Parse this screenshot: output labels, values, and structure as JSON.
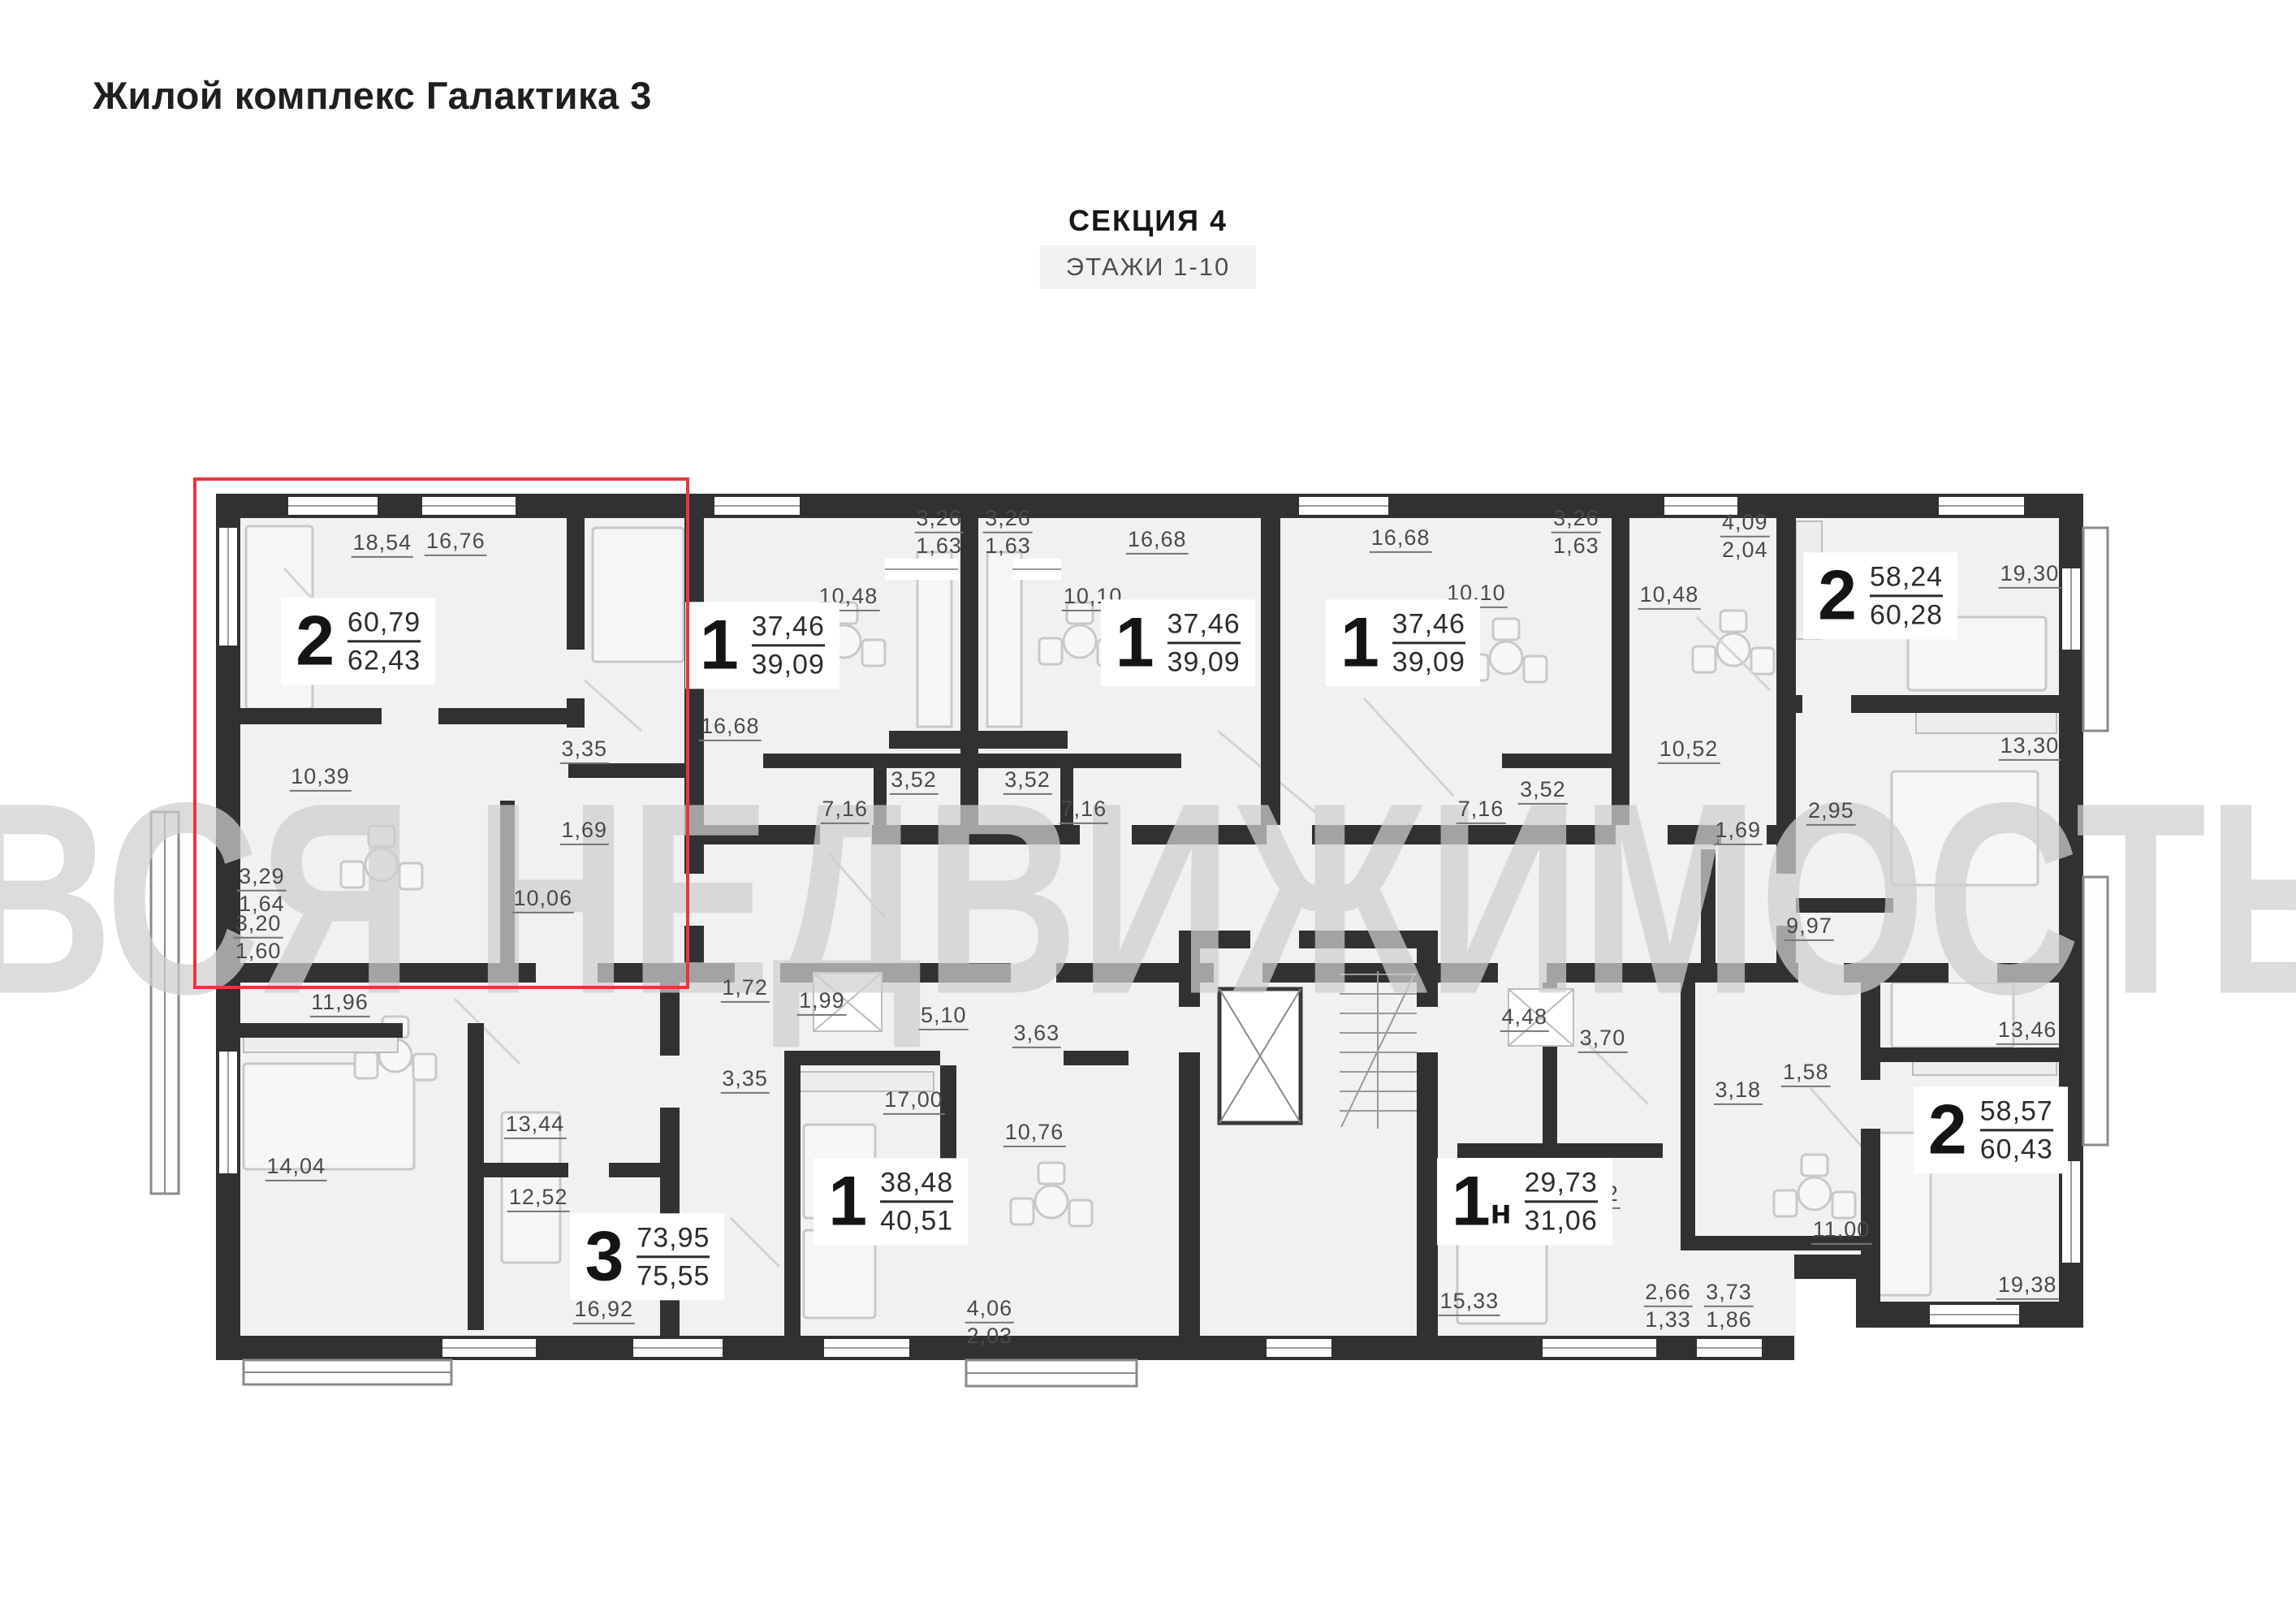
{
  "title": "Жилой комплекс Галактика 3",
  "header": {
    "section": "СЕКЦИЯ 4",
    "floors": "ЭТАЖИ 1-10"
  },
  "watermark": "ВСЯ НЕДВИЖИМОСТЬ",
  "highlight": {
    "x": 8.4,
    "y": 29.4,
    "w": 21.35,
    "h": 31.1
  },
  "apartments": [
    {
      "type": "2",
      "sub": "",
      "area_top": "60,79",
      "area_bot": "62,43",
      "x": 15.6,
      "y": 39.5,
      "highlighted": true
    },
    {
      "type": "1",
      "sub": "",
      "area_top": "37,46",
      "area_bot": "39,09",
      "x": 33.2,
      "y": 39.75,
      "highlighted": false
    },
    {
      "type": "1",
      "sub": "",
      "area_top": "37,46",
      "area_bot": "39,09",
      "x": 51.3,
      "y": 39.6,
      "highlighted": false
    },
    {
      "type": "1",
      "sub": "",
      "area_top": "37,46",
      "area_bot": "39,09",
      "x": 61.1,
      "y": 39.6,
      "highlighted": false
    },
    {
      "type": "2",
      "sub": "",
      "area_top": "58,24",
      "area_bot": "60,28",
      "x": 81.9,
      "y": 36.7,
      "highlighted": false
    },
    {
      "type": "3",
      "sub": "",
      "area_top": "73,95",
      "area_bot": "75,55",
      "x": 28.2,
      "y": 77.4,
      "highlighted": false
    },
    {
      "type": "1",
      "sub": "",
      "area_top": "38,48",
      "area_bot": "40,51",
      "x": 38.8,
      "y": 74.0,
      "highlighted": false
    },
    {
      "type": "1",
      "sub": "н",
      "area_top": "29,73",
      "area_bot": "31,06",
      "x": 66.4,
      "y": 74.0,
      "highlighted": false
    },
    {
      "type": "2",
      "sub": "",
      "area_top": "58,57",
      "area_bot": "60,43",
      "x": 86.7,
      "y": 69.6,
      "highlighted": false
    }
  ],
  "rooms": [
    {
      "label": "18,54",
      "label2": "",
      "x": 16.65,
      "y": 33.5
    },
    {
      "label": "16,76",
      "label2": "",
      "x": 19.85,
      "y": 33.4
    },
    {
      "label": "10,39",
      "label2": "",
      "x": 13.95,
      "y": 47.9
    },
    {
      "label": "3,35",
      "label2": "",
      "x": 25.45,
      "y": 46.2
    },
    {
      "label": "1,69",
      "label2": "",
      "x": 25.45,
      "y": 51.2
    },
    {
      "label": "10,06",
      "label2": "",
      "x": 23.65,
      "y": 55.4
    },
    {
      "label": "3,29",
      "label2": "1,64",
      "x": 11.4,
      "y": 54.8
    },
    {
      "label": "3,20",
      "label2": "1,60",
      "x": 11.25,
      "y": 57.7
    },
    {
      "label": "16,68",
      "label2": "",
      "x": 31.8,
      "y": 44.8
    },
    {
      "label": "10,48",
      "label2": "",
      "x": 36.95,
      "y": 36.8
    },
    {
      "label": "3,26",
      "label2": "1,63",
      "x": 40.9,
      "y": 32.75
    },
    {
      "label": "3,52",
      "label2": "",
      "x": 39.8,
      "y": 48.1
    },
    {
      "label": "7,16",
      "label2": "",
      "x": 36.8,
      "y": 49.9
    },
    {
      "label": "3,26",
      "label2": "1,63",
      "x": 43.9,
      "y": 32.75
    },
    {
      "label": "10,10",
      "label2": "",
      "x": 47.6,
      "y": 36.8
    },
    {
      "label": "16,68",
      "label2": "",
      "x": 50.4,
      "y": 33.3
    },
    {
      "label": "3,52",
      "label2": "",
      "x": 44.75,
      "y": 48.1
    },
    {
      "label": "7,16",
      "label2": "",
      "x": 47.2,
      "y": 49.9
    },
    {
      "label": "16,68",
      "label2": "",
      "x": 61.0,
      "y": 33.2
    },
    {
      "label": "10,10",
      "label2": "",
      "x": 64.3,
      "y": 36.6
    },
    {
      "label": "3,26",
      "label2": "1,63",
      "x": 68.65,
      "y": 32.75
    },
    {
      "label": "3,52",
      "label2": "",
      "x": 67.2,
      "y": 48.7
    },
    {
      "label": "7,16",
      "label2": "",
      "x": 64.5,
      "y": 49.9
    },
    {
      "label": "4,09",
      "label2": "2,04",
      "x": 76.0,
      "y": 33.0
    },
    {
      "label": "10,48",
      "label2": "",
      "x": 72.7,
      "y": 36.7
    },
    {
      "label": "19,30",
      "label2": "",
      "x": 88.4,
      "y": 35.4
    },
    {
      "label": "10,52",
      "label2": "",
      "x": 73.55,
      "y": 46.2
    },
    {
      "label": "1,69",
      "label2": "",
      "x": 75.7,
      "y": 51.2
    },
    {
      "label": "2,95",
      "label2": "",
      "x": 79.75,
      "y": 50.0
    },
    {
      "label": "13,30",
      "label2": "",
      "x": 88.4,
      "y": 46.0
    },
    {
      "label": "9,97",
      "label2": "",
      "x": 78.8,
      "y": 57.1
    },
    {
      "label": "11,96",
      "label2": "",
      "x": 14.8,
      "y": 61.8
    },
    {
      "label": "14,04",
      "label2": "",
      "x": 12.9,
      "y": 71.9
    },
    {
      "label": "13,44",
      "label2": "",
      "x": 23.3,
      "y": 69.3
    },
    {
      "label": "12,52",
      "label2": "",
      "x": 23.45,
      "y": 73.8
    },
    {
      "label": "16,92",
      "label2": "",
      "x": 26.3,
      "y": 80.7
    },
    {
      "label": "1,72",
      "label2": "",
      "x": 32.45,
      "y": 60.9
    },
    {
      "label": "1,99",
      "label2": "",
      "x": 35.8,
      "y": 61.7
    },
    {
      "label": "5,10",
      "label2": "",
      "x": 41.1,
      "y": 62.6
    },
    {
      "label": "3,63",
      "label2": "",
      "x": 45.15,
      "y": 63.7
    },
    {
      "label": "3,35",
      "label2": "",
      "x": 32.45,
      "y": 66.5
    },
    {
      "label": "17,00",
      "label2": "",
      "x": 39.8,
      "y": 67.8
    },
    {
      "label": "10,76",
      "label2": "",
      "x": 45.05,
      "y": 69.8
    },
    {
      "label": "4,06",
      "label2": "2,03",
      "x": 43.1,
      "y": 81.4
    },
    {
      "label": "4,48",
      "label2": "",
      "x": 66.4,
      "y": 62.7
    },
    {
      "label": "3,70",
      "label2": "",
      "x": 69.8,
      "y": 64.0
    },
    {
      "label": "3,18",
      "label2": "",
      "x": 75.7,
      "y": 67.2
    },
    {
      "label": "1,58",
      "label2": "",
      "x": 78.65,
      "y": 66.1
    },
    {
      "label": "6,22",
      "label2": "",
      "x": 69.5,
      "y": 73.6
    },
    {
      "label": "15,33",
      "label2": "",
      "x": 64.0,
      "y": 80.2
    },
    {
      "label": "2,66",
      "label2": "1,33",
      "x": 72.65,
      "y": 80.4
    },
    {
      "label": "3,73",
      "label2": "1,86",
      "x": 75.3,
      "y": 80.4
    },
    {
      "label": "11,00",
      "label2": "",
      "x": 80.2,
      "y": 75.8
    },
    {
      "label": "13,46",
      "label2": "",
      "x": 88.3,
      "y": 63.5
    },
    {
      "label": "19,38",
      "label2": "",
      "x": 88.3,
      "y": 79.2
    }
  ],
  "colors": {
    "highlight": "#e8363d",
    "wall": "#313133",
    "floor": "#f1f1f2",
    "watermark": "#cfcfcf"
  }
}
